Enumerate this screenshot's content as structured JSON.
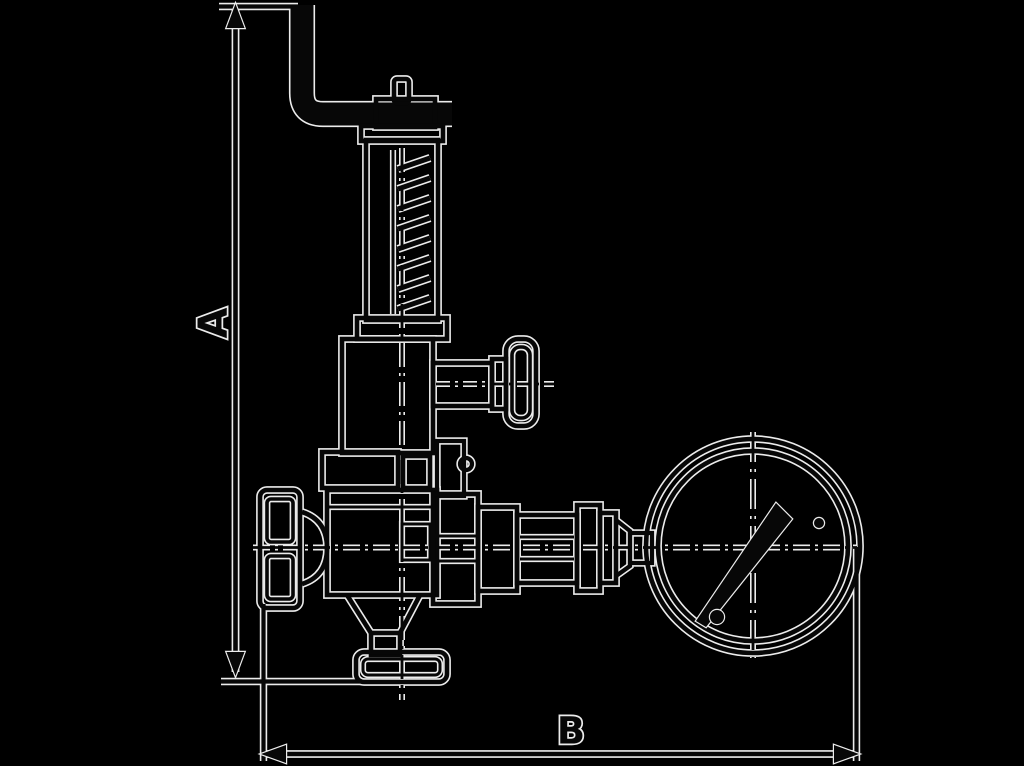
{
  "page": {
    "width": 1024,
    "height": 766,
    "background": "#000000"
  },
  "colors": {
    "line_halo": "#ececec",
    "line_core": "#070707",
    "background": "#000000"
  },
  "diagram": {
    "kind": "technical-outline-drawing",
    "subject": "Spring-loaded safety relief valve with lifting lever and pressure gauge, side elevation with overall dimension callouts",
    "dimension_labels": {
      "vertical": "A",
      "horizontal": "B"
    },
    "dimensions": [
      {
        "label": "A",
        "orientation": "vertical",
        "measures": "overall height from outlet flange base line to top of lever"
      },
      {
        "label": "B",
        "orientation": "horizontal",
        "measures": "overall width from body end cap to outer edge of pressure gauge"
      }
    ],
    "components": [
      "bent lever handle",
      "lever pivot pin and nut",
      "spring bonnet",
      "coil spring",
      "side test knob",
      "valve body",
      "end cap flange",
      "bottom outlet flange",
      "gauge connection fittings",
      "pressure gauge dial",
      "gauge needle",
      "dial screws"
    ]
  }
}
